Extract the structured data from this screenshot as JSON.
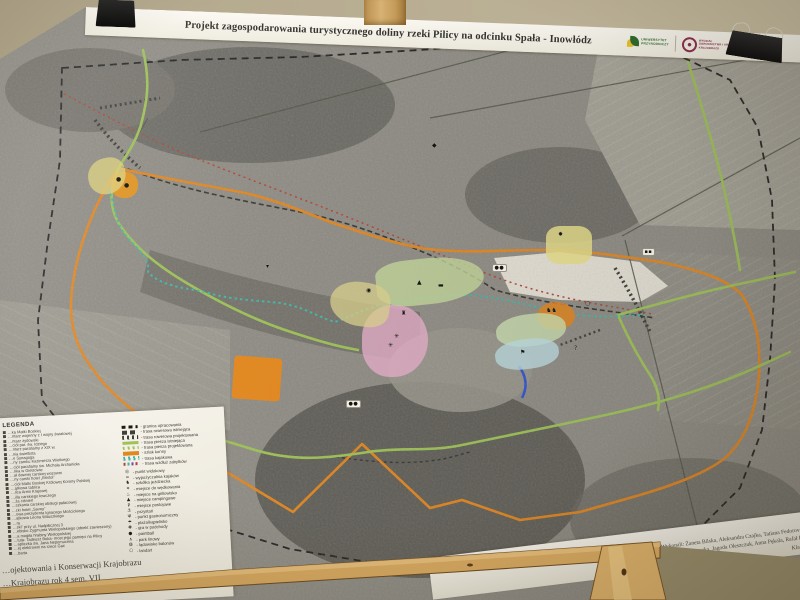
{
  "poster": {
    "title": "Projekt zagospodarowania turystycznego doliny rzeki Pilicy na odcinku Spała - Inowłódz",
    "logos": {
      "university": {
        "line1": "UNIWERSYTET",
        "line2": "PRZYRODNICZY",
        "green": "#2f6b2f",
        "yellow": "#e7c32b"
      },
      "faculty": {
        "line1": "WYDZIAŁ",
        "line2": "OGRODNICTWA I ARCHITEKTURY",
        "line3": "KRAJOBRAZU",
        "maroon": "#8e2f4f"
      }
    }
  },
  "legend": {
    "title": "LEGENDA",
    "places": [
      "…ka Matki Boskiej",
      "…ntarz wojenny z I wojny światowej",
      "…ntarz żydowski",
      "…ciół par. św. Idziego",
      "…ntarz parafialny z XIX w.",
      "…nia świetlista",
      "…e Synagoga",
      "…ny zamku Kazimierza Wielkiego",
      "…ciół parafialny św. Michała Archanioła",
      "…ńka w Giełzowie",
      "…ał dawnej carskiej wozowni",
      "…ny carski hotel „Bristol”",
      "…ciół Matki Boskiej Królowej Korony Polskiej",
      "…ątkowa tablica",
      "…lica Armii Krajowej",
      "…illa carskiego łowczego",
      "…ża ciśnień",
      "…szkania carskiej obsługi pałacowej",
      "…cki hotel „Savoy”",
      "…owa prezydenta Ignacego Mościckiego",
      "…ątkowa Leona Wituszkiego",
      "…ra",
      "…ski” przy ul. Nadpilicznej 3",
      "…ebisko Zygmunta Wielopolskiego (obiekt zawieszony)",
      "…a mogiła hrabiny Wielopolskiej",
      "…tuta- Tadeusz Buka- most jego pamięci na Pilicy",
      "…apliczka św. Jana Nepomucena",
      "…ej elektrowni na rzece Gać",
      "…barta"
    ],
    "routes": [
      {
        "label": "- granica opracowania",
        "style": "dash-black"
      },
      {
        "label": "- trasa rowerowa istniejąca",
        "style": "dash-dark"
      },
      {
        "label": "- trasa rowerowa projektowana",
        "style": "dot-dark"
      },
      {
        "label": "- trasa piesza istniejąca",
        "style": "solid-green"
      },
      {
        "label": "- trasa piesza projektowana",
        "style": "dot-green"
      },
      {
        "label": "- szlak konny",
        "style": "solid-orange"
      },
      {
        "label": "- trasa kajakowa",
        "style": "dot-teal"
      },
      {
        "label": "- trasa wzdłuż zabytków",
        "style": "dot-multi"
      }
    ],
    "points": [
      {
        "glyph": "◎",
        "label": "- punkt widokowy"
      },
      {
        "glyph": "≈",
        "label": "- wypożyczalnia kajaków"
      },
      {
        "glyph": "♞",
        "label": "- szkółka jeździecka"
      },
      {
        "glyph": "✶",
        "label": "- miejsce do wędkowania"
      },
      {
        "glyph": "♨",
        "label": "- miejsce na grillowisko"
      },
      {
        "glyph": "▲",
        "label": "- miejsce campingowe"
      },
      {
        "glyph": "P",
        "label": "- miejsce postojowe"
      },
      {
        "glyph": "⚓",
        "label": "- przystań"
      },
      {
        "glyph": "Ψ",
        "label": "- punkt gastronomiczny"
      },
      {
        "glyph": "☂",
        "label": "- plaża/kąpielisko"
      },
      {
        "glyph": "✚",
        "label": "- gra w podchody"
      },
      {
        "glyph": "●",
        "label": "- paintball"
      },
      {
        "glyph": "∧",
        "label": "- park linowy"
      },
      {
        "glyph": "◍",
        "label": "- lądowisko balonów"
      },
      {
        "glyph": "○",
        "label": "- landart"
      }
    ]
  },
  "credits": {
    "lines": [
      "Wykonali: Żaneta Bilska, Aleksandra Czajka, Tatiana Fedorova, Marta J…",
      "Jola Ławocka, Jagoda Oleszczuk, Anna Pękala, Rafał Pasiak, Ag…",
      "Klaudia Wojta…"
    ]
  },
  "footer": {
    "lines": [
      "…ojektowania i Konserwacji Krajobrazu",
      "…Krajobrazu rok 4 sem. VII"
    ]
  },
  "map": {
    "colors": {
      "horse_trail": "#e2841b",
      "walking_trail": "#9cc153",
      "kayak_trail": "#3fb3a5",
      "bike_trail": "#34322d",
      "heritage_trail": "#b04030",
      "boundary": "#1f1f1f",
      "river_blue": "#2a4fd0"
    },
    "zones": [
      {
        "name": "zone-pink",
        "color": "#e3aec8",
        "x": 362,
        "y": 305,
        "w": 66,
        "h": 72,
        "r": "48% 52% 55% 45%",
        "o": 0.8,
        "rot": 0
      },
      {
        "name": "zone-green-river",
        "color": "#c3d69b",
        "x": 376,
        "y": 258,
        "w": 108,
        "h": 46,
        "r": "35% 60% 60% 40%",
        "o": 0.8,
        "rot": -6
      },
      {
        "name": "zone-yellow-west",
        "color": "#d9d08e",
        "x": 330,
        "y": 282,
        "w": 60,
        "h": 44,
        "r": "55% 45% 40% 60%",
        "o": 0.75,
        "rot": 8
      },
      {
        "name": "zone-yellow-ne",
        "color": "#e4dc8a",
        "x": 546,
        "y": 226,
        "w": 46,
        "h": 38,
        "r": "30%",
        "o": 0.85,
        "rot": 0
      },
      {
        "name": "zone-orange-mill",
        "color": "#dd8628",
        "x": 537,
        "y": 302,
        "w": 38,
        "h": 28,
        "r": "50%",
        "o": 0.9,
        "rot": 0
      },
      {
        "name": "zone-green-se",
        "color": "#c9ddb0",
        "x": 496,
        "y": 314,
        "w": 70,
        "h": 32,
        "r": "45%",
        "o": 0.8,
        "rot": -7
      },
      {
        "name": "zone-blue-se",
        "color": "#bcd9de",
        "x": 495,
        "y": 339,
        "w": 64,
        "h": 30,
        "r": "45%",
        "o": 0.8,
        "rot": -7
      },
      {
        "name": "zone-orange-field",
        "color": "#e88a1c",
        "x": 233,
        "y": 357,
        "w": 48,
        "h": 43,
        "r": "8%",
        "o": 0.92,
        "rot": 4
      },
      {
        "name": "zone-orange-spala",
        "color": "#e8961e",
        "x": 111,
        "y": 172,
        "w": 27,
        "h": 26,
        "r": "45%",
        "o": 0.9,
        "rot": 0
      },
      {
        "name": "zone-yellow-spala",
        "color": "#ddd27e",
        "x": 88,
        "y": 158,
        "w": 38,
        "h": 36,
        "r": "50% 40% 55% 45%",
        "o": 0.75,
        "rot": -12
      }
    ],
    "icons": [
      {
        "g": "▲",
        "x": 417,
        "y": 280
      },
      {
        "g": "▬",
        "x": 438,
        "y": 283
      },
      {
        "g": "◉",
        "x": 366,
        "y": 288
      },
      {
        "g": "♜",
        "x": 401,
        "y": 311
      },
      {
        "g": "✳",
        "x": 394,
        "y": 334
      },
      {
        "g": "✳",
        "x": 388,
        "y": 343
      },
      {
        "g": "●●",
        "x": 492,
        "y": 264,
        "box": true
      },
      {
        "g": "●●",
        "x": 346,
        "y": 400,
        "box": true
      },
      {
        "g": "▪▪",
        "x": 642,
        "y": 248,
        "box": true
      },
      {
        "g": "♞♞",
        "x": 546,
        "y": 308
      },
      {
        "g": "✸",
        "x": 558,
        "y": 232
      },
      {
        "g": "○",
        "x": 585,
        "y": 301
      },
      {
        "g": "?",
        "x": 574,
        "y": 346
      },
      {
        "g": "◆",
        "x": 432,
        "y": 143
      },
      {
        "g": "⚑",
        "x": 520,
        "y": 350
      },
      {
        "g": "●",
        "x": 116,
        "y": 177
      },
      {
        "g": "●",
        "x": 124,
        "y": 183
      },
      {
        "g": "▾",
        "x": 266,
        "y": 264
      }
    ]
  },
  "environment": {
    "wall_color": "#b7ac92",
    "wood_color": "#cd9f5e",
    "clip_color": "#1b1b1b"
  }
}
